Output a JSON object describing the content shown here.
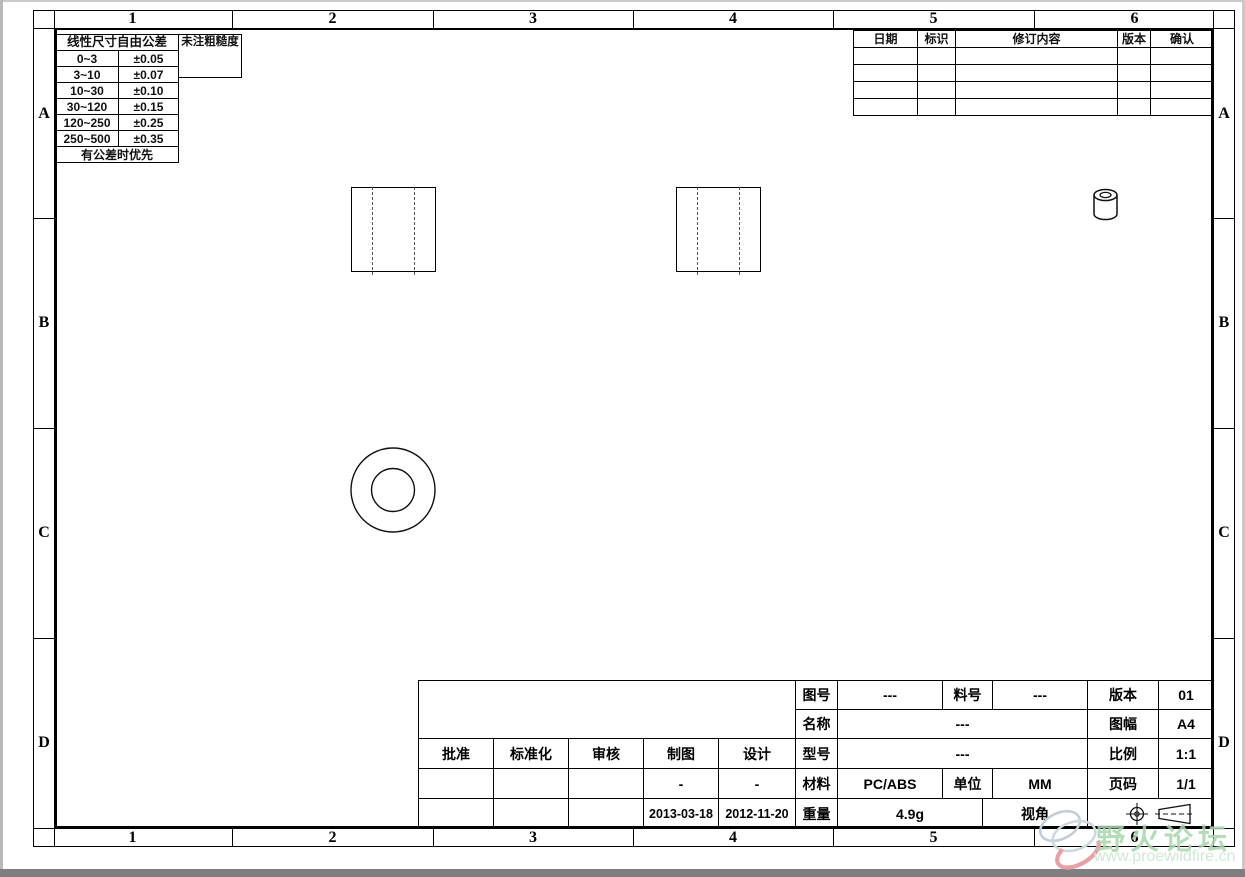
{
  "page": {
    "type": "CAD engineering drawing sheet",
    "line_color": "#000000",
    "background": "#ffffff"
  },
  "zones": {
    "columns": [
      "1",
      "2",
      "3",
      "4",
      "5",
      "6"
    ],
    "rows": [
      "A",
      "B",
      "C",
      "D"
    ]
  },
  "tolerance_table": {
    "title": "线性尺寸自由公差",
    "roughness_title": "未注粗糙度",
    "rows": [
      {
        "range": "0~3",
        "tol": "±0.05"
      },
      {
        "range": "3~10",
        "tol": "±0.07"
      },
      {
        "range": "10~30",
        "tol": "±0.10"
      },
      {
        "range": "30~120",
        "tol": "±0.15"
      },
      {
        "range": "120~250",
        "tol": "±0.25"
      },
      {
        "range": "250~500",
        "tol": "±0.35"
      }
    ],
    "footer": "有公差时优先"
  },
  "revision_table": {
    "headers": {
      "date": "日期",
      "mark": "标识",
      "content": "修订内容",
      "version": "版本",
      "confirm": "确认"
    },
    "empty_row_count": 4
  },
  "title_block": {
    "approve_label": "批准",
    "standardize_label": "标准化",
    "review_label": "审核",
    "draft_label": "制图",
    "design_label": "设计",
    "draft_dash": "-",
    "design_dash": "-",
    "draft_date": "2013-03-18",
    "design_date": "2012-11-20",
    "drawing_no_label": "图号",
    "drawing_no": "---",
    "part_no_label": "料号",
    "part_no": "---",
    "version_label": "版本",
    "version": "01",
    "name_label": "名称",
    "name": "---",
    "sheet_label": "图幅",
    "sheet": "A4",
    "model_label": "型号",
    "model": "---",
    "scale_label": "比例",
    "scale": "1:1",
    "material_label": "材料",
    "material": "PC/ABS",
    "unit_label": "单位",
    "unit": "MM",
    "page_label": "页码",
    "page": "1/1",
    "weight_label": "重量",
    "weight": "4.9g",
    "view_label": "视角"
  },
  "views": {
    "left_side_view": "rectangle with two dashed hidden lines",
    "right_side_view": "rectangle with two dashed hidden lines",
    "front_view": "two concentric circles",
    "iso_view": "small 3D cylinder with hole"
  },
  "watermark": {
    "title": "野火论坛",
    "url": "www.proewildfire.cn",
    "title_color": "#a8d7ab",
    "url_color": "#cfe9d3",
    "logo_gray": "#c3cdd6",
    "logo_pink": "#e8a0a5"
  }
}
